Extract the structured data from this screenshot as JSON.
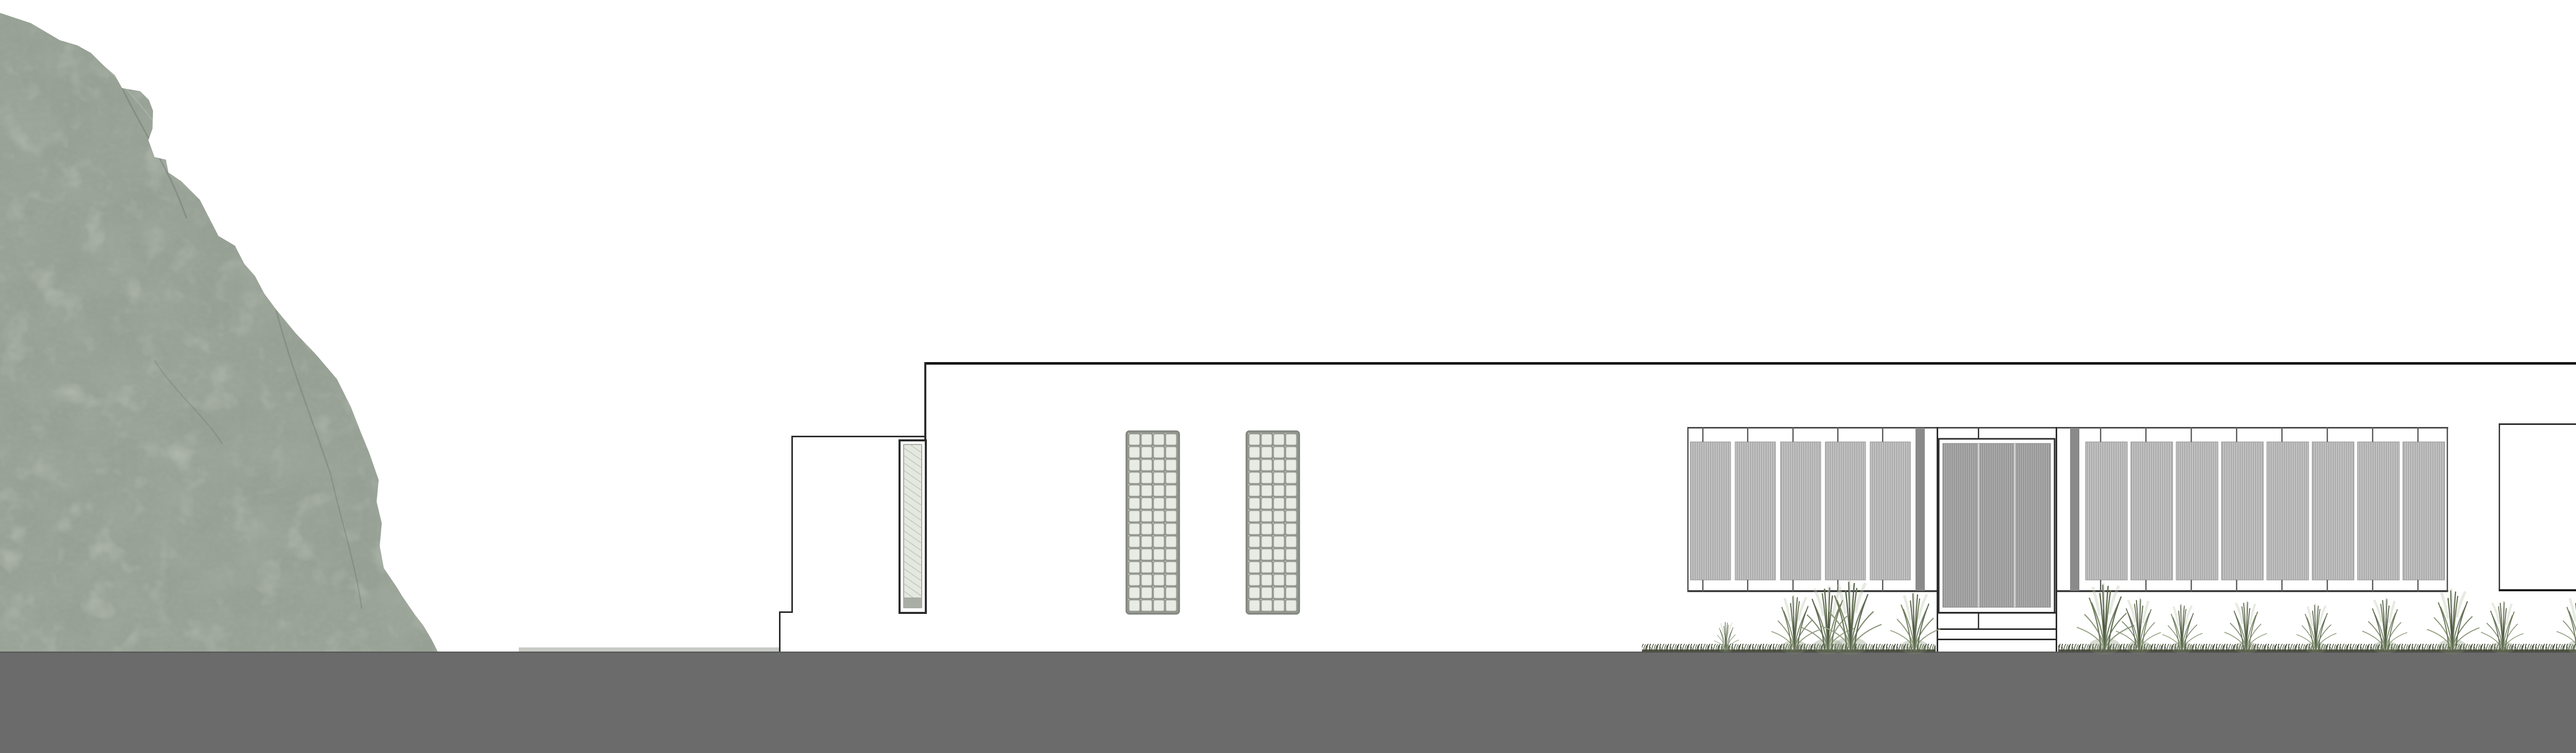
{
  "drawing": {
    "type": "architectural-front-elevation",
    "scene": "single-storey house elevation with rock outcrop at left, planted grasses, gray ground band"
  },
  "logo": {
    "line1": "MARINA",
    "line2": "VELLA",
    "tagline": "ARQUITECTURA | URBANISMO"
  },
  "colors": {
    "background": "#ffffff",
    "ground": "#6b6b6b",
    "ground_edge": "#5a5a5a",
    "step_strip": "#c8cbc5",
    "rock_base": "#97a094",
    "rock_dark": "#5f695c",
    "rock_light": "#c3cabd",
    "line_dark": "#161616",
    "line_mid": "#2b2b2b",
    "frame_gray": "#4a4a4a",
    "tick_gray": "#5a5a5a",
    "panel_gray": "#bdbdbd",
    "panel_stripe": "#a5a5a5",
    "panel_hi": "#cbcbcb",
    "door_gray": "#a4a4a4",
    "door_stripe": "#909090",
    "door_seam": "#d2d2d2",
    "pilaster_gray": "#8a8a8a",
    "screen_frame": "#92968e",
    "screen_frame_edge": "#7e837b",
    "screen_cell": "#e9ebe5",
    "screen_cell_edge": "#c6c9c0",
    "glass_tint": "#e4e8e0",
    "glass_hatch": "#b9c2b2",
    "glass_sill": "#a9ada5",
    "plant_dark": "#4a553d",
    "plant_mid1": "#5c684f",
    "plant_mid2": "#6b7859",
    "plant_mid3": "#75836a",
    "plant_soft1": "#7d8a6e",
    "plant_soft2": "#8d9a7d",
    "plant_pale1": "#9aa687",
    "plant_pale2": "#b9c2aa",
    "plant_pale3": "#c6cdb8",
    "grass_dark": "#333b28",
    "grass_mid": "#4a5340",
    "grass_soft": "#5d684d",
    "logo_text": "#332b22",
    "logo_sub": "#4a4a43"
  }
}
